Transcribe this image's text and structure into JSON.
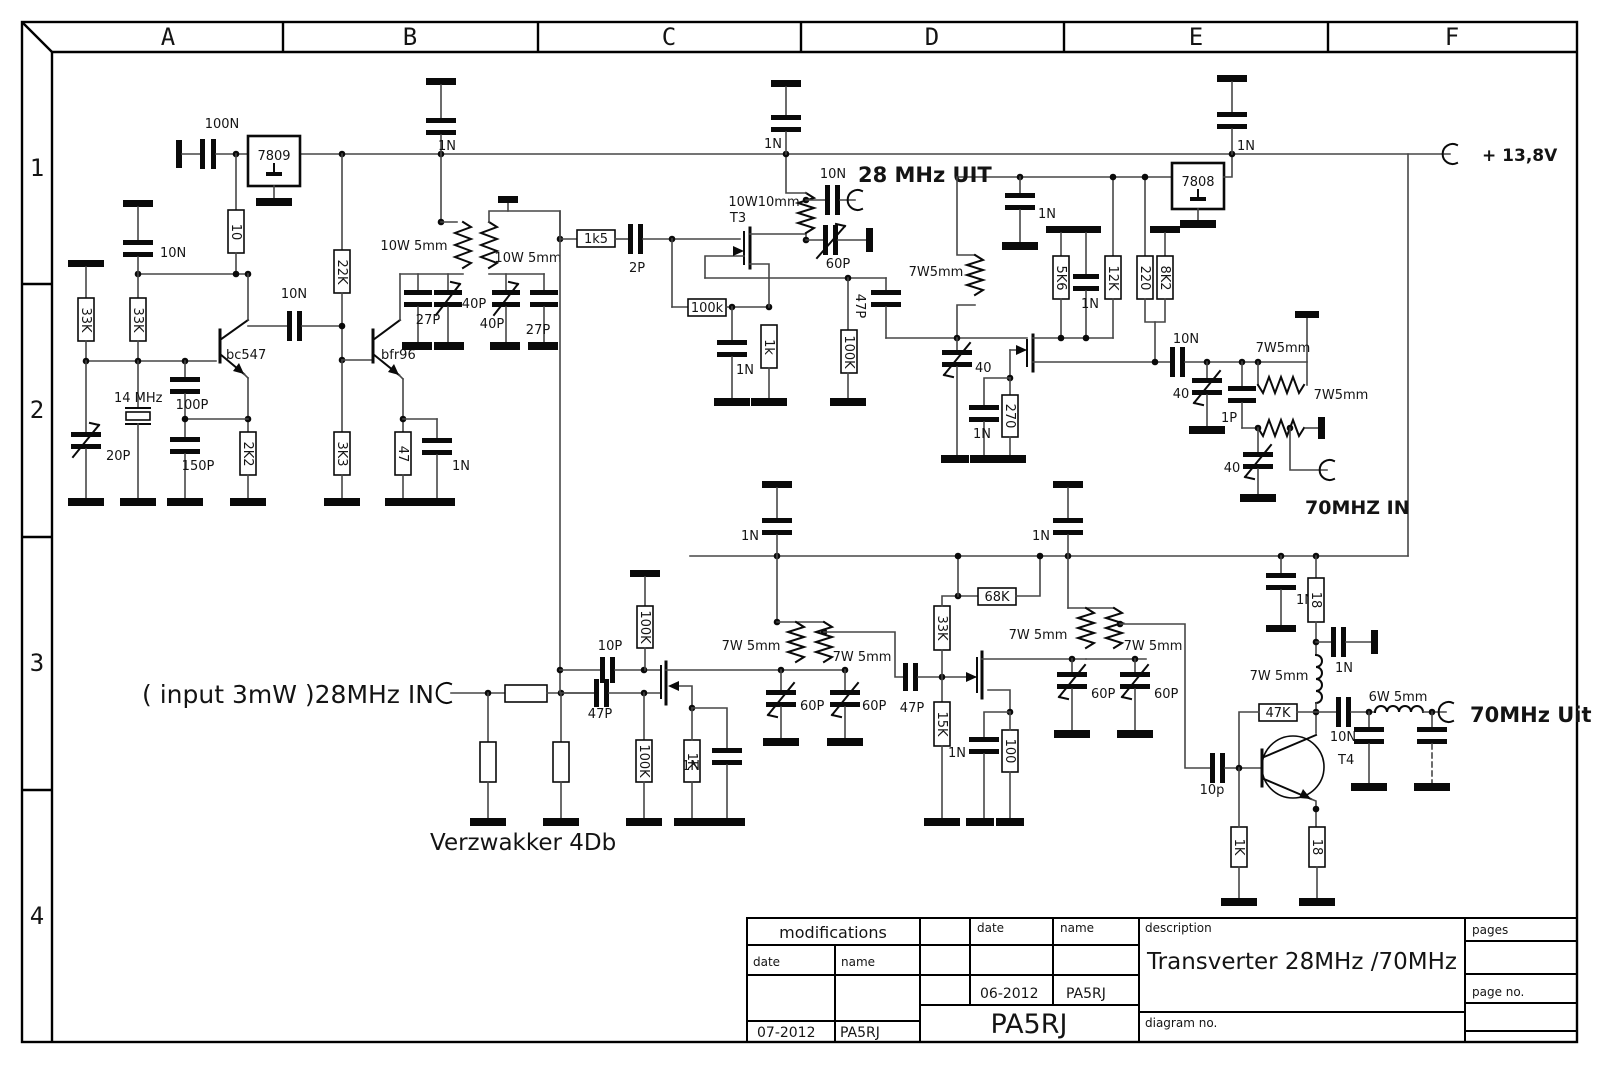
{
  "frame": {
    "columns": [
      "A",
      "B",
      "C",
      "D",
      "E",
      "F"
    ],
    "rows": [
      "1",
      "2",
      "3",
      "4"
    ]
  },
  "title_block": {
    "modifications": "modifications",
    "date_label": "date",
    "name_label": "name",
    "date_label2": "date",
    "name_label2": "name",
    "description_label": "description",
    "description": "Transverter 28MHz /70MHz",
    "diagram_no_label": "diagram no.",
    "pages_label": "pages",
    "page_no_label": "page no.",
    "rev1_date": "06-2012",
    "rev1_name": "PA5RJ",
    "rev2_date": "07-2012",
    "rev2_name": "PA5RJ",
    "author": "PA5RJ"
  },
  "labels": {
    "c100n": "100N",
    "reg9": "7809",
    "r10": "10",
    "c10n_a": "10N",
    "r33k_a": "33K",
    "r33k_b": "33K",
    "c10n_b": "10N",
    "q1": "bc547",
    "xtal": "14 MHz",
    "c100p": "100P",
    "c20p": "20P",
    "c150p": "150P",
    "r2k2": "2K2",
    "r22k": "22K",
    "q2": "bfr96",
    "r3k3": "3K3",
    "r47": "47",
    "c1n_q2": "1N",
    "c1n_top_b": "1N",
    "lw1": "10W 5mm",
    "lw2": "10W 5mm",
    "c27p_a": "27P",
    "c40p_a": "40P",
    "c40p_b": "40P",
    "c27p_b": "27P",
    "r1k5": "1k5",
    "c2p": "2P",
    "t3": "T3",
    "l10w10": "10W10mm",
    "c10n_tx": "10N",
    "out28": "28 MHz UIT",
    "c60p_tx": "60P",
    "r100k_t3g": "100k",
    "r1k_t3": "1k",
    "c1n_t3": "1N",
    "c47p_c": "47P",
    "r100k_c": "100K",
    "c1n_top_c": "1N",
    "c1n_d": "1N",
    "l7w5_d": "7W5mm",
    "r5k6": "5K6",
    "c1n_mid": "1N",
    "r12k": "12K",
    "r220": "220",
    "r8k2": "8K2",
    "reg8": "7808",
    "c1n_top_e": "1N",
    "c40_rx": "40",
    "r270": "270",
    "c1n_rx": "1N",
    "c10n_e": "10N",
    "c40_e1": "40",
    "l7w5_e1": "7W5mm",
    "c1p": "1P",
    "l7w5_e2": "7W5mm",
    "c40_e2": "40",
    "in70": "70MHZ IN",
    "supply": "+ 13,8V",
    "in28": "( input 3mW )28MHz IN",
    "verz": "Verzwakker 4Db",
    "c47p_b1": "47P",
    "c10p": "10P",
    "r100k_b1": "100K",
    "r100k_b2": "100K",
    "r1k_b1": "1K",
    "c1n_b1": "1N",
    "l7w5_b1": "7W 5mm",
    "l7w5_b2": "7W 5mm",
    "c60p_b1": "60P",
    "c60p_b2": "60P",
    "c47p_b2": "47P",
    "r33k_m2": "33K",
    "r15k_m2": "15K",
    "c1n_m2": "1N",
    "r100_m2": "100",
    "r68k": "68K",
    "l7w5_b3": "7W 5mm",
    "l7w5_b4": "7W 5mm",
    "c60p_b3": "60P",
    "c60p_b4": "60P",
    "c1n_r1": "1N",
    "c1n_r2": "1N",
    "c1n_e3": "1N",
    "r18_a": "18",
    "c1n_lpf": "1N",
    "l7w5_t4": "7W 5mm",
    "r47k": "47K",
    "c10n_t4": "10N",
    "t4": "T4",
    "l6w5": "6W 5mm",
    "out70": "70MHz Uit",
    "c10p_t4": "10p",
    "r1k_t4": "1K",
    "r18_b": "18"
  }
}
